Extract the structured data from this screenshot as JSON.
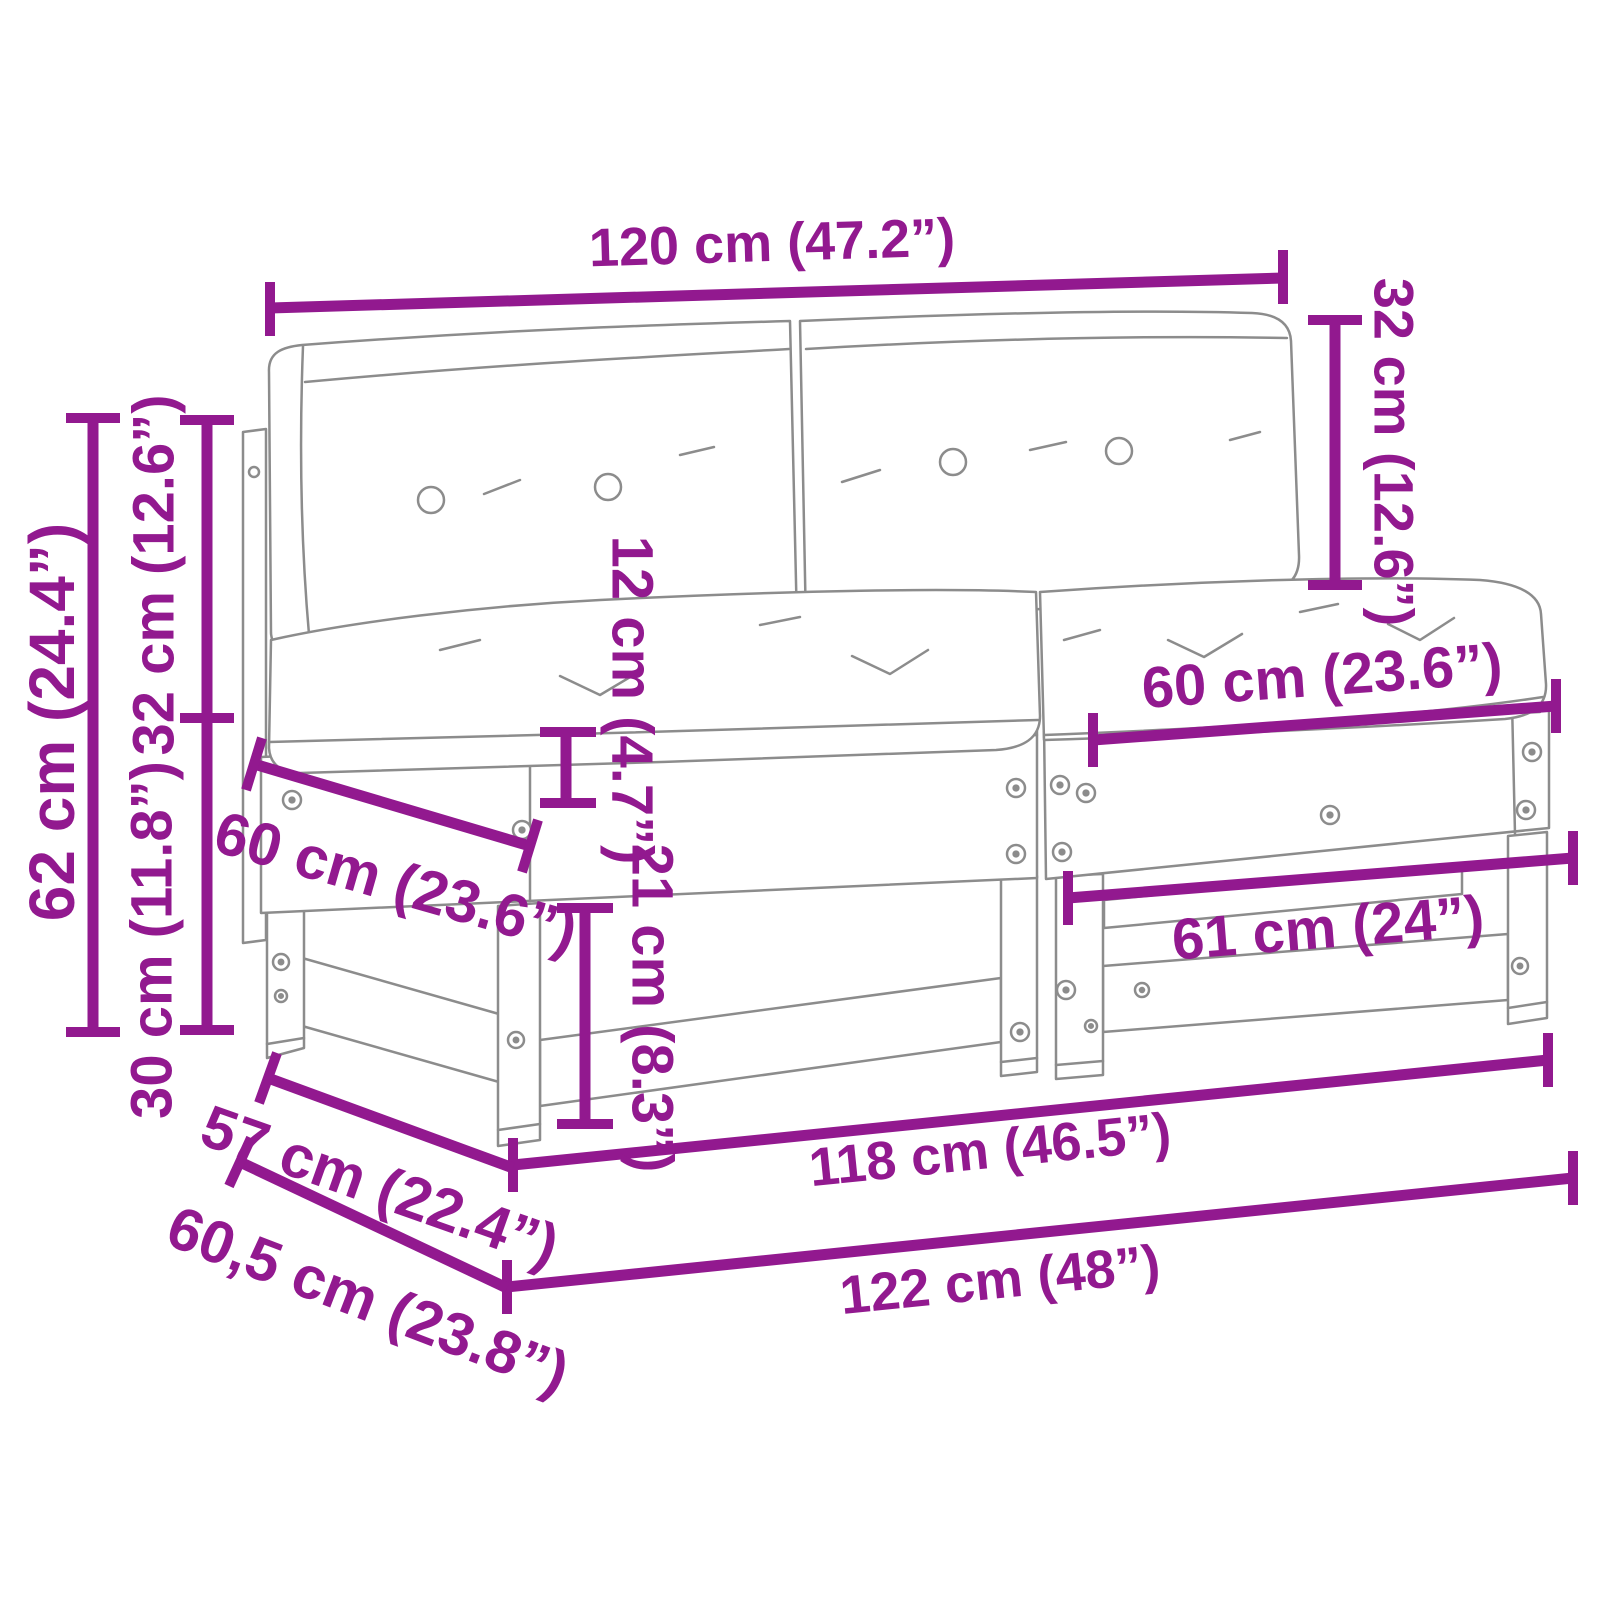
{
  "diagram": {
    "type": "product-dimension-diagram",
    "subject": "2-piece garden pallet sofa set with cushions"
  },
  "colors": {
    "dimension": "#92198F",
    "sketch": "#8c8c8c",
    "background": "#ffffff"
  },
  "labels": {
    "back_width": "120 cm (47.2”)",
    "back_cushion_height": "32 cm (12.6”)",
    "overall_height": "62 cm (24.4”)",
    "backrest_height": "32 cm (12.6”)",
    "base_height": "30 cm (11.8”)",
    "cushion_thickness": "12 cm (4.7”)",
    "clearance_height": "21 cm (8.3”)",
    "seat_depth_side": "60 cm (23.6”)",
    "cushion_width": "60 cm (23.6”)",
    "inner_width": "61 cm (24”)",
    "frame_width": "118 cm (46.5”)",
    "overall_width": "122 cm (48”)",
    "depth": "57 cm (22.4”)",
    "overall_depth": "60,5 cm (23.8”)"
  }
}
